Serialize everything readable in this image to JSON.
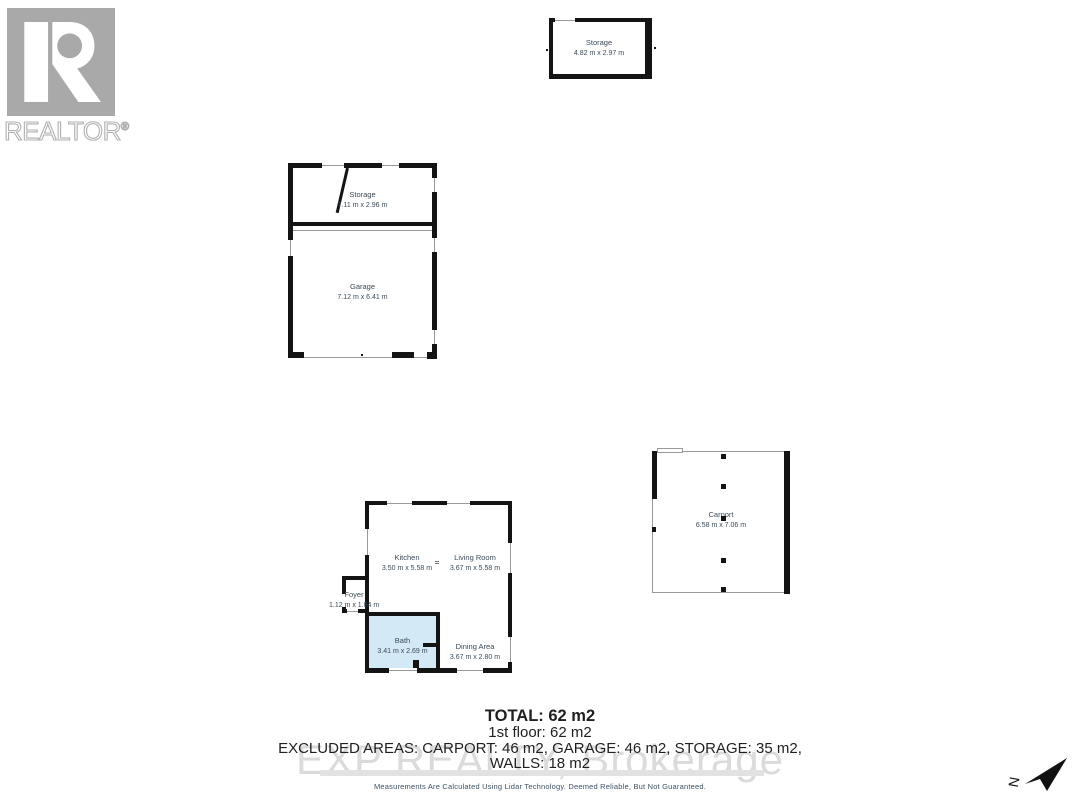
{
  "branding": {
    "logo_text": "REALTOR",
    "registered_mark": "®"
  },
  "plans": {
    "storage_building": {
      "name": "Storage",
      "dims": "4.82 m x 2.97 m"
    },
    "garage_building": {
      "storage": {
        "name": "Storage",
        "dims": "7.11 m x 2.96 m"
      },
      "garage": {
        "name": "Garage",
        "dims": "7.12 m x 6.41 m"
      }
    },
    "first_floor": {
      "kitchen": {
        "name": "Kitchen",
        "dims": "3.50 m x 5.58 m"
      },
      "living_room": {
        "name": "Living Room",
        "dims": "3.67 m x 5.58 m"
      },
      "foyer": {
        "name": "Foyer",
        "dims": "1.12 m x 1.84 m"
      },
      "bath": {
        "name": "Bath",
        "dims": "3.41 m x 2.69 m"
      },
      "dining_area": {
        "name": "Dining Area",
        "dims": "3.67 m x 2.80 m"
      }
    },
    "carport": {
      "name": "Carport",
      "dims": "6.58 m x 7.06 m"
    }
  },
  "summary": {
    "total": "TOTAL: 62 m2",
    "first_floor": "1st floor: 62 m2",
    "excluded_areas": "EXCLUDED AREAS: CARPORT: 46 m2, GARAGE: 46 m2, STORAGE: 35 m2,",
    "walls": "WALLS: 18 m2"
  },
  "watermark": "EXP REALTY, Brokerage",
  "disclaimer": "Measurements Are Calculated Using Lidar Technology. Deemed Reliable, But Not Guaranteed.",
  "compass": {
    "label": "N"
  },
  "colors": {
    "wall": "#141414",
    "bath_fill": "#d3e9f6",
    "room_label": "#3a4a57",
    "watermark": "#dbdbdb",
    "logo_gray": "#a9a9a9",
    "disclaimer_text": "#3d5166"
  }
}
